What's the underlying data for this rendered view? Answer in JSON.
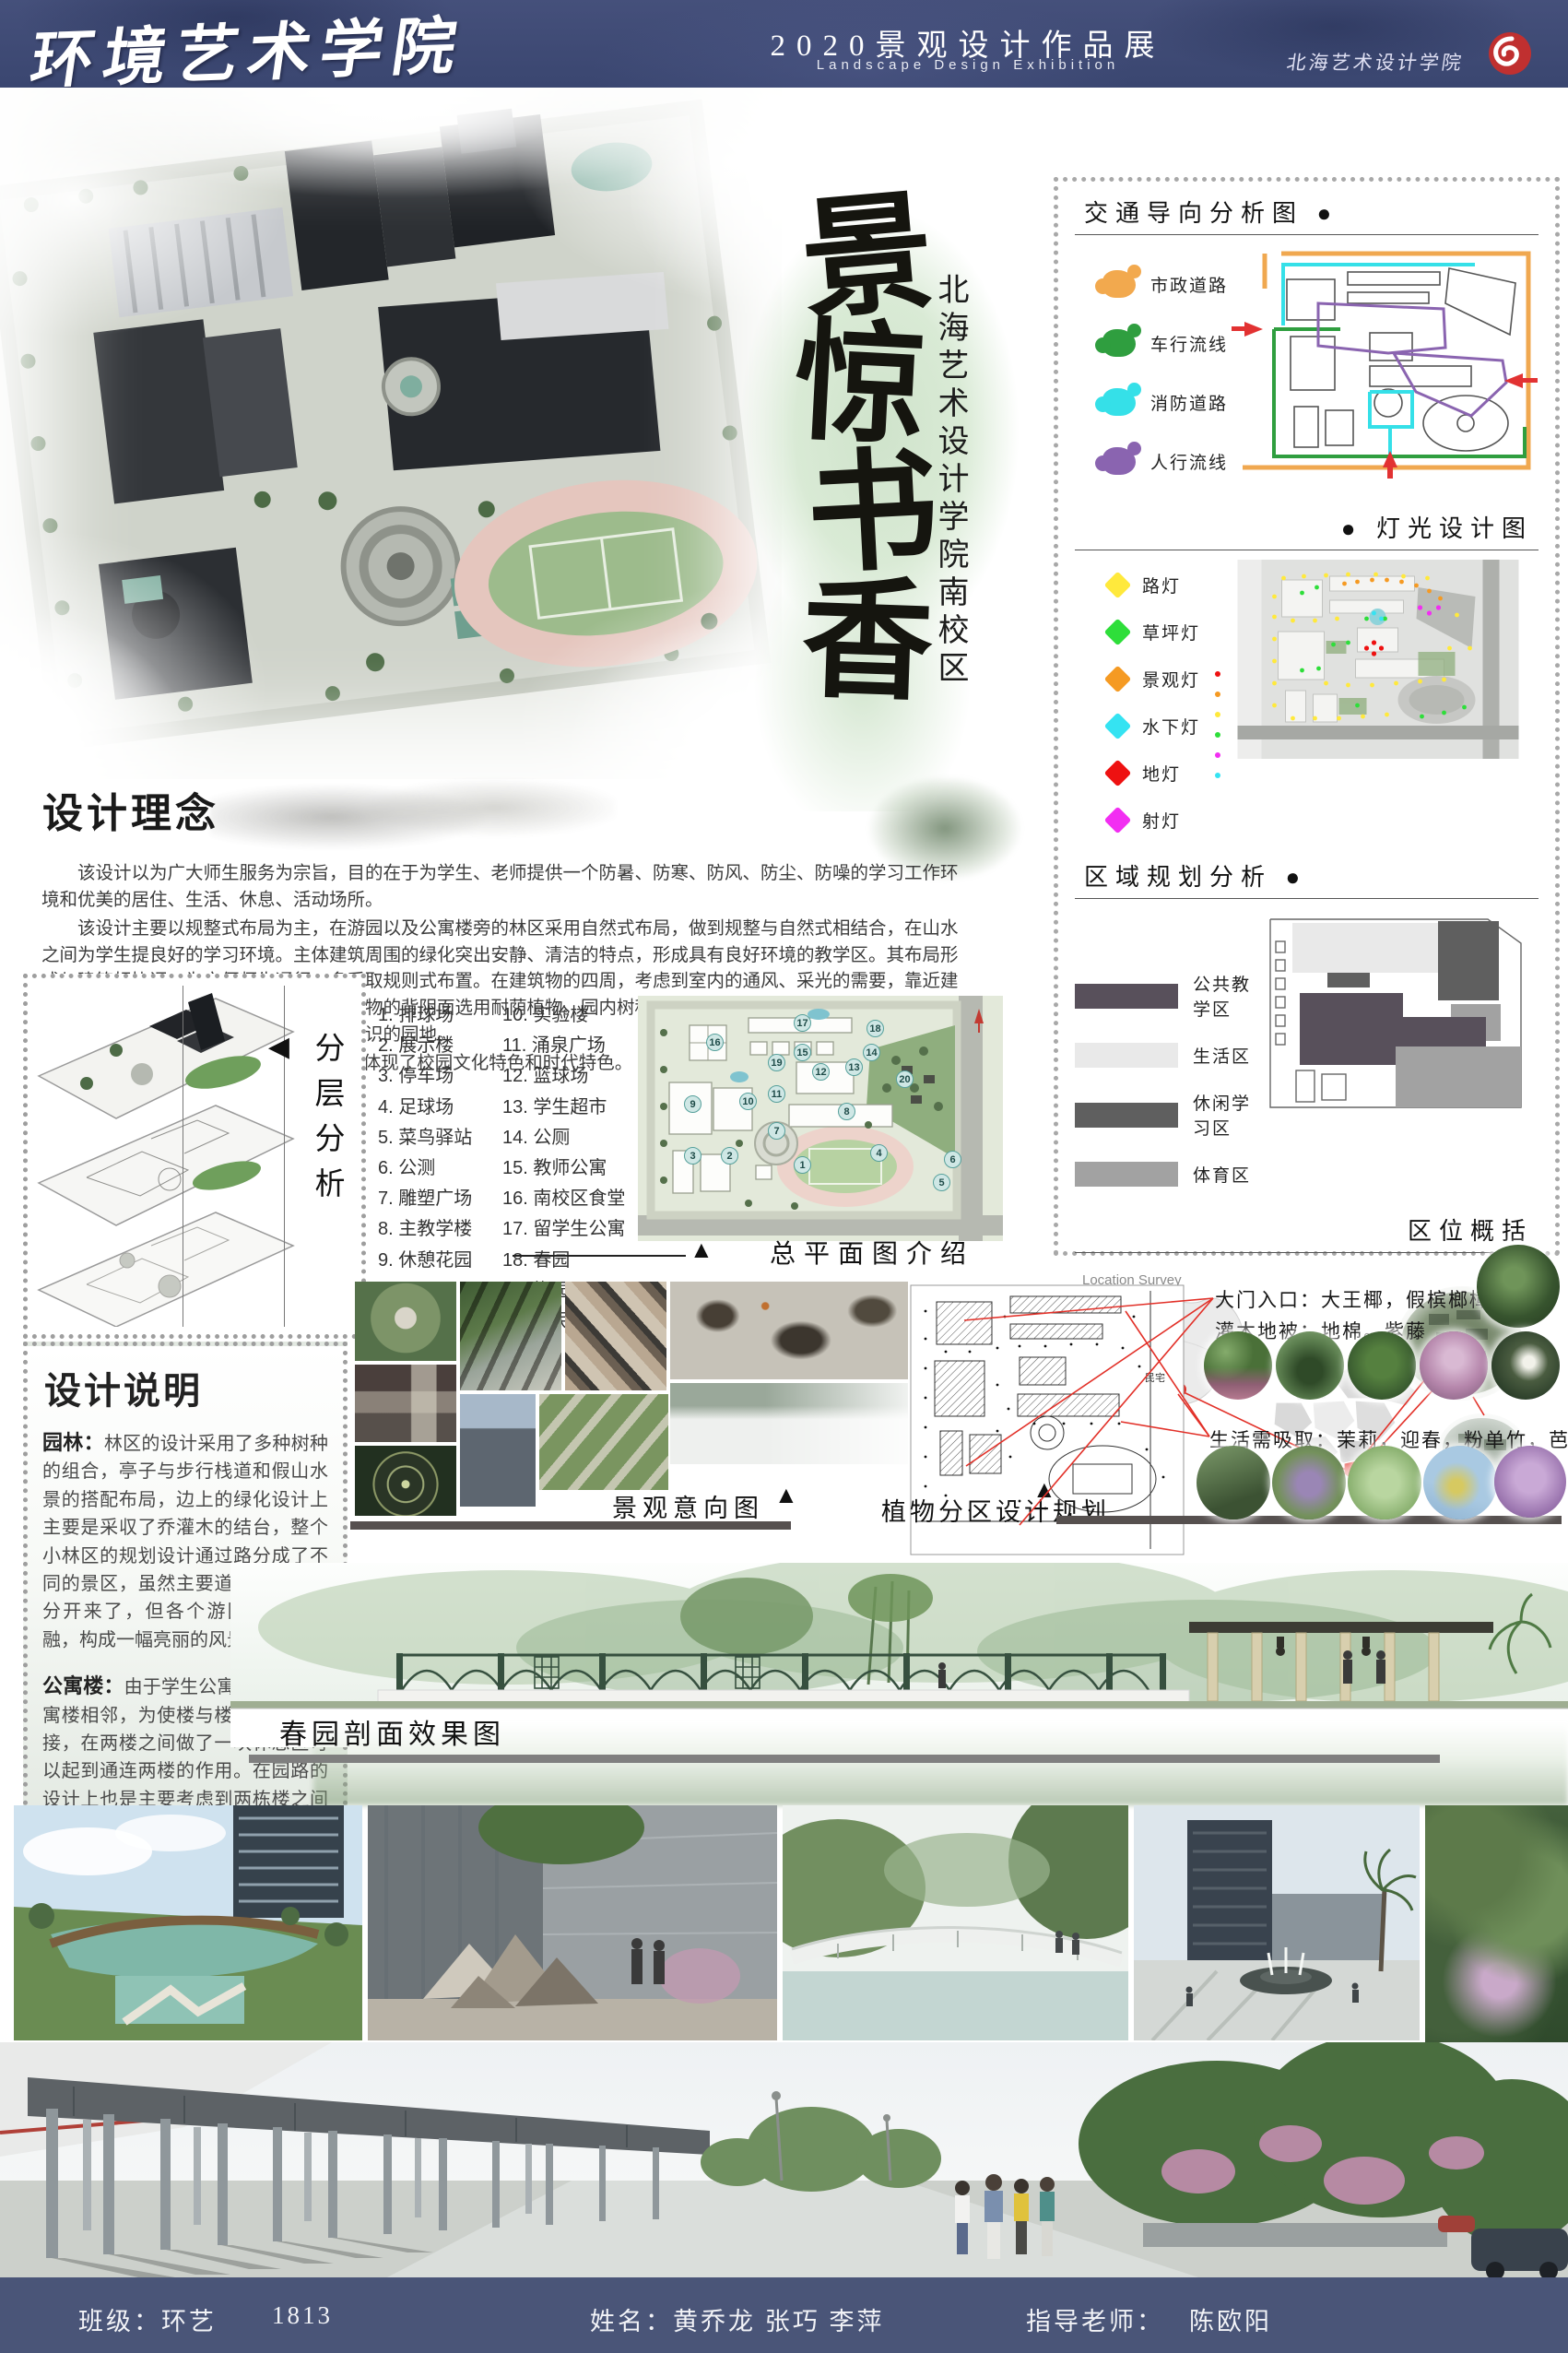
{
  "icons": {
    "triangle_up": "▲",
    "triangle_left": "◀"
  },
  "header": {
    "college": "环境艺术学院",
    "exhibition_cn": "2020景观设计作品展",
    "exhibition_en": "Landscape Design Exhibition",
    "school_seal": "北海艺术设计学院"
  },
  "hero": {
    "title_chars": [
      "景",
      "惊",
      "书",
      "香"
    ],
    "campus_label": "北海艺术设计学院南校区"
  },
  "panels": {
    "traffic": {
      "title": "交通导向分析图",
      "bullet": "●",
      "legend": [
        {
          "label": "市政道路",
          "color": "#f2a94e"
        },
        {
          "label": "车行流线",
          "color": "#2f9e3f"
        },
        {
          "label": "消防道路",
          "color": "#35e0e8"
        },
        {
          "label": "人行流线",
          "color": "#8a64b0"
        }
      ]
    },
    "lighting": {
      "title": "灯光设计图",
      "bullet": "●",
      "legend": [
        {
          "label": "路灯",
          "color": "#ffe93c"
        },
        {
          "label": "草坪灯",
          "color": "#2ede3a"
        },
        {
          "label": "景观灯",
          "color": "#f59a23"
        },
        {
          "label": "水下灯",
          "color": "#35e3f2"
        },
        {
          "label": "地灯",
          "color": "#ee1111"
        },
        {
          "label": "射灯",
          "color": "#f22ef2"
        }
      ]
    },
    "zoning": {
      "title": "区域规划分析",
      "bullet": "●",
      "legend": [
        {
          "label": "公共教学区",
          "color": "#58505b"
        },
        {
          "label": "生活区",
          "color": "#e9e9e9"
        },
        {
          "label": "休闲学习区",
          "color": "#5f5f5f"
        },
        {
          "label": "体育区",
          "color": "#a2a2a2"
        }
      ]
    },
    "location": {
      "title": "区位概括",
      "survey_label": "Location Survey"
    }
  },
  "concept": {
    "heading": "设计理念",
    "para1": "该设计以为广大师生服务为宗旨，目的在于为学生、老师提供一个防暑、防寒、防风、防尘、防噪的学习工作环境和优美的居住、生活、休息、活动场所。",
    "para2": "该设计主要以规整式布局为主，在游园以及公寓楼旁的林区采用自然式布局，做到规整与自然式相结合，在山水之间为学生提良好的学习环境。主体建筑周围的绿化突出安静、清洁的特点，形成具有良好环境的教学区。其布局形式与建筑相协调，为方便师生通行，多采取规则式布置。在建筑物的四周，考虑到室内的通风、采光的需要，靠近建筑物栽植了低矮灌木或宿根花卉，在建筑物的背阴面选用耐荫植物。园内树种丰富，并挂牌标明树种的名称、特性、原产地等，使整个校园成为普及生物学知识的园地。",
    "para3": "本设计中设计理念主要突出以“人”为本，体现了校园文化特色和时代特色。"
  },
  "layers": {
    "title": "分层分析"
  },
  "master_plan": {
    "caption": "总平面图介绍",
    "items_col1": [
      "1. 排球场",
      "2. 展示楼",
      "3. 停车场",
      "4. 足球场",
      "5. 菜鸟驿站",
      "6. 公测",
      "7. 雕塑广场",
      "8. 主教学楼",
      "9. 休憩花园"
    ],
    "items_col2": [
      "10. 实验楼",
      "11. 涌泉广场",
      "12. 篮球场",
      "13. 学生超市",
      "14. 公厕",
      "15. 教师公寓",
      "16. 南校区食堂",
      "17. 留学生公寓",
      "18. 春园",
      "19. 梅园",
      "20. 居民区"
    ],
    "markers": [
      "1",
      "2",
      "3",
      "4",
      "5",
      "6",
      "7",
      "8",
      "9",
      "10",
      "11",
      "12",
      "13",
      "14",
      "15",
      "16",
      "17",
      "18",
      "19",
      "20"
    ]
  },
  "description": {
    "heading": "设计说明",
    "garden_label": "园林：",
    "garden_text": "林区的设计采用了多种树种的组合，亭子与步行栈道和假山水景的搭配布局，边上的绿化设计上主要是采収了乔灌木的结台，整个小林区的规划设计通过路分成了不同的景区，虽然主要道路把它们划分开来了，但各个游园都有机相融，构成一幅亮丽的风景",
    "apartment_label": "公寓楼：",
    "apartment_text": "由于学生公寓楼与专家公寓楼相邻，为使楼与楼之间相互连接，在两楼之间做了一块休息区可以起到通连两楼的作用。在园路的设计上也是主要考虑到两栋楼之间的走动与学生们的活动，在周围的绿化植物主要是迎春，丁香和大王椰等，给人一种花香四溢的感觉。"
  },
  "intent": {
    "caption": "景观意向图"
  },
  "plants": {
    "caption": "植物分区设计规划",
    "entrance_line": "大门入口：大王椰，假槟榔樟树",
    "shrub_line": "灌木地被：地棉。紫藤",
    "living_line": "生活需吸取：茉莉，迎春，粉单竹，芭蕉",
    "cad_note": "民宅"
  },
  "section_view": {
    "caption": "春园剖面效果图"
  },
  "footer": {
    "class_text": "班级：环艺",
    "class_no": "1813",
    "names_text": "姓名：黄乔龙 张巧 李萍",
    "advisor_text": "指导老师：",
    "advisor_name": "陈欧阳"
  }
}
